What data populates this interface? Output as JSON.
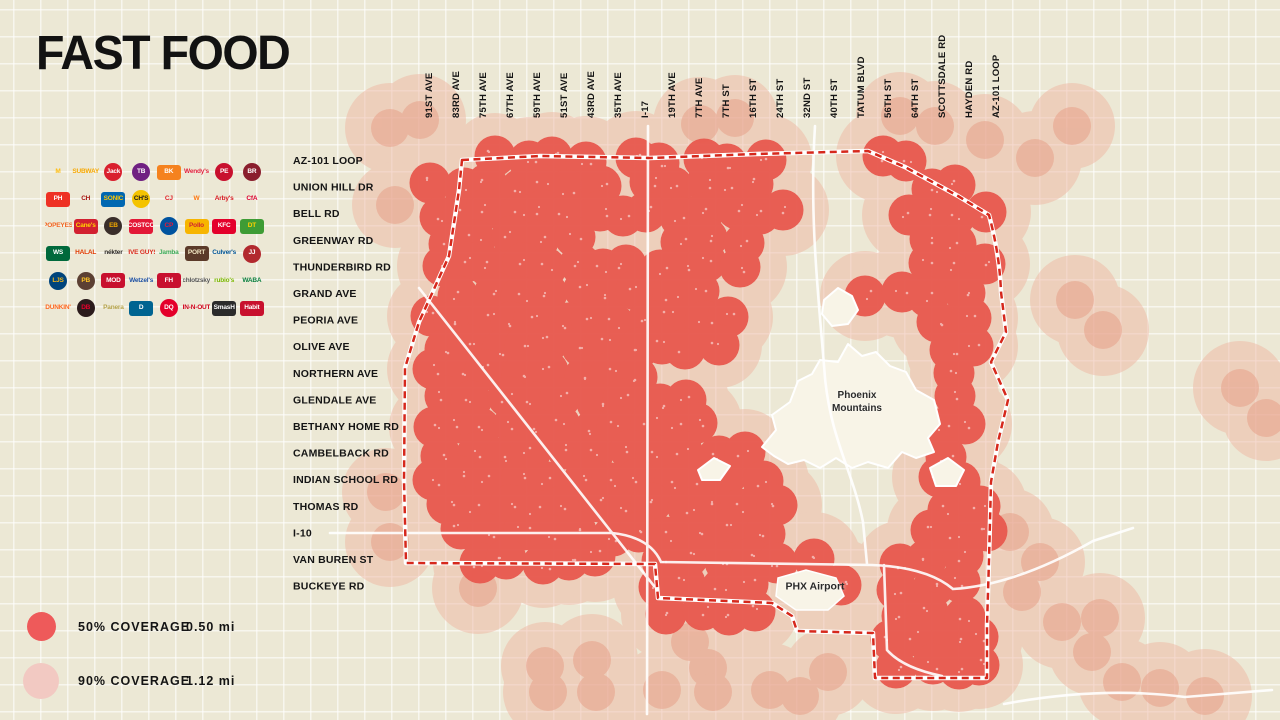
{
  "title": "FAST FOOD",
  "legend": {
    "items": [
      {
        "label": "50% COVERAGE",
        "value": "0.50 mi"
      },
      {
        "label": "90% COVERAGE",
        "value": "1.12 mi"
      }
    ]
  },
  "axes": {
    "top": [
      "91ST AVE",
      "83RD AVE",
      "75TH AVE",
      "67TH AVE",
      "59TH AVE",
      "51ST AVE",
      "43RD AVE",
      "35TH AVE",
      "I-17",
      "19TH AVE",
      "7TH AVE",
      "7TH ST",
      "16TH ST",
      "24TH ST",
      "32ND ST",
      "40TH ST",
      "TATUM BLVD",
      "56TH ST",
      "64TH ST",
      "SCOTTSDALE RD",
      "HAYDEN RD",
      "AZ-101 LOOP"
    ],
    "left": [
      "AZ-101 LOOP",
      "UNION HILL DR",
      "BELL RD",
      "GREENWAY RD",
      "THUNDERBIRD RD",
      "GRAND AVE",
      "PEORIA AVE",
      "OLIVE AVE",
      "NORTHERN AVE",
      "GLENDALE AVE",
      "BETHANY HOME RD",
      "CAMBELBACK RD",
      "INDIAN SCHOOL RD",
      "THOMAS RD",
      "I-10",
      "VAN BUREN ST",
      "BUCKEYE RD"
    ]
  },
  "logos": [
    {
      "name": "mcdonalds",
      "abbr": "M",
      "shape": "text",
      "bg": "",
      "fg": "#FFBC0D"
    },
    {
      "name": "subway",
      "abbr": "SUBWAY",
      "shape": "text",
      "bg": "",
      "fg": "#F7A800"
    },
    {
      "name": "jack-in-the-box",
      "abbr": "Jack",
      "shape": "circle",
      "bg": "#D91F2D",
      "fg": "#FFFFFF"
    },
    {
      "name": "taco-bell",
      "abbr": "TB",
      "shape": "circle",
      "bg": "#702082",
      "fg": "#FFFFFF"
    },
    {
      "name": "burger-king",
      "abbr": "BK",
      "shape": "rect",
      "bg": "#F5821F",
      "fg": "#FFFFFF"
    },
    {
      "name": "wendys",
      "abbr": "Wendy's",
      "shape": "text",
      "bg": "",
      "fg": "#E2203D"
    },
    {
      "name": "panda-express",
      "abbr": "PE",
      "shape": "circle",
      "bg": "#C8102E",
      "fg": "#FFFFFF"
    },
    {
      "name": "black-rock-coffee",
      "abbr": "BR",
      "shape": "circle",
      "bg": "#8A1E2D",
      "fg": "#FFFFFF"
    },
    {
      "name": "pizza-hut",
      "abbr": "PH",
      "shape": "rect",
      "bg": "#EE3124",
      "fg": "#FFFFFF"
    },
    {
      "name": "chipotle",
      "abbr": "CH",
      "shape": "text",
      "bg": "",
      "fg": "#A81612"
    },
    {
      "name": "sonic",
      "abbr": "SONIC",
      "shape": "rect",
      "bg": "#0067B1",
      "fg": "#FFC600"
    },
    {
      "name": "churchs-chicken",
      "abbr": "CH'S",
      "shape": "circle",
      "bg": "#F4C300",
      "fg": "#1A1A1A"
    },
    {
      "name": "carls-jr",
      "abbr": "CJ",
      "shape": "text",
      "bg": "",
      "fg": "#E0252B"
    },
    {
      "name": "whataburger",
      "abbr": "W",
      "shape": "text",
      "bg": "",
      "fg": "#FF770F"
    },
    {
      "name": "arbys",
      "abbr": "Arby's",
      "shape": "text",
      "bg": "",
      "fg": "#D71921"
    },
    {
      "name": "chick-fil-a",
      "abbr": "CfA",
      "shape": "text",
      "bg": "",
      "fg": "#DD0031"
    },
    {
      "name": "popeyes",
      "abbr": "POPEYES",
      "shape": "text",
      "bg": "",
      "fg": "#F26522"
    },
    {
      "name": "raising-canes",
      "abbr": "Cane's",
      "shape": "rect",
      "bg": "#D22030",
      "fg": "#FFD200"
    },
    {
      "name": "einstein-bros",
      "abbr": "EB",
      "shape": "circle",
      "bg": "#3A2E2A",
      "fg": "#F2A900"
    },
    {
      "name": "costco",
      "abbr": "COSTCO",
      "shape": "rect",
      "bg": "#E31837",
      "fg": "#FFFFFF"
    },
    {
      "name": "charleys",
      "abbr": "CP",
      "shape": "circle",
      "bg": "#00539F",
      "fg": "#E51937"
    },
    {
      "name": "el-pollo-loco",
      "abbr": "Pollo",
      "shape": "rect",
      "bg": "#F7B500",
      "fg": "#D22630"
    },
    {
      "name": "kfc",
      "abbr": "KFC",
      "shape": "rect",
      "bg": "#E4002B",
      "fg": "#FFFFFF"
    },
    {
      "name": "del-taco",
      "abbr": "DT",
      "shape": "rect",
      "bg": "#3E9C35",
      "fg": "#FFD100"
    },
    {
      "name": "wingstop",
      "abbr": "WS",
      "shape": "rect",
      "bg": "#00693C",
      "fg": "#FFFFFF"
    },
    {
      "name": "halal-guys",
      "abbr": "HALAL",
      "shape": "text",
      "bg": "",
      "fg": "#E03A00"
    },
    {
      "name": "nekter",
      "abbr": "nékter",
      "shape": "text",
      "bg": "",
      "fg": "#2D2926"
    },
    {
      "name": "five-guys",
      "abbr": "FIVE GUYS",
      "shape": "text",
      "bg": "",
      "fg": "#DA291C"
    },
    {
      "name": "jamba",
      "abbr": "Jamba",
      "shape": "text",
      "bg": "",
      "fg": "#3DAA57"
    },
    {
      "name": "portillos",
      "abbr": "PORT",
      "shape": "rect",
      "bg": "#5B3A29",
      "fg": "#F1E6C2"
    },
    {
      "name": "culvers",
      "abbr": "Culver's",
      "shape": "text",
      "bg": "",
      "fg": "#005596"
    },
    {
      "name": "jimmy-johns",
      "abbr": "JJ",
      "shape": "circle",
      "bg": "#B2292E",
      "fg": "#FFFFFF"
    },
    {
      "name": "long-john-silvers",
      "abbr": "LJS",
      "shape": "circle",
      "bg": "#00447C",
      "fg": "#F7B718"
    },
    {
      "name": "potbelly",
      "abbr": "PB",
      "shape": "circle",
      "bg": "#5C4033",
      "fg": "#FFC425"
    },
    {
      "name": "mod-pizza",
      "abbr": "MOD",
      "shape": "rect",
      "bg": "#C8102E",
      "fg": "#FFFFFF"
    },
    {
      "name": "wetzels-pretzels",
      "abbr": "Wetzel's",
      "shape": "text",
      "bg": "",
      "fg": "#1C4FA1"
    },
    {
      "name": "firehouse-subs",
      "abbr": "FH",
      "shape": "rect",
      "bg": "#C8102E",
      "fg": "#FFFFFF"
    },
    {
      "name": "schlotzskys",
      "abbr": "Schlotzsky's",
      "shape": "text",
      "bg": "",
      "fg": "#555555"
    },
    {
      "name": "rubios",
      "abbr": "rubio's",
      "shape": "text",
      "bg": "",
      "fg": "#7AB800"
    },
    {
      "name": "waba-grill",
      "abbr": "WABA",
      "shape": "text",
      "bg": "",
      "fg": "#0C8040"
    },
    {
      "name": "dunkin",
      "abbr": "DUNKIN'",
      "shape": "text",
      "bg": "",
      "fg": "#FF671F"
    },
    {
      "name": "dutch-bros",
      "abbr": "DB",
      "shape": "circle",
      "bg": "#2B1B1C",
      "fg": "#E4002B"
    },
    {
      "name": "panera-bread",
      "abbr": "Panera",
      "shape": "text",
      "bg": "",
      "fg": "#B5A249"
    },
    {
      "name": "dominos",
      "abbr": "D",
      "shape": "rect",
      "bg": "#006491",
      "fg": "#FFFFFF"
    },
    {
      "name": "dairy-queen",
      "abbr": "DQ",
      "shape": "circle",
      "bg": "#E4002B",
      "fg": "#FFFFFF"
    },
    {
      "name": "in-n-out",
      "abbr": "IN-N-OUT",
      "shape": "text",
      "bg": "",
      "fg": "#D0021B"
    },
    {
      "name": "smashburger",
      "abbr": "SmasH",
      "shape": "rect",
      "bg": "#2B2B2B",
      "fg": "#FFFFFF"
    },
    {
      "name": "the-habit",
      "abbr": "Habit",
      "shape": "rect",
      "bg": "#C8102E",
      "fg": "#FFFFFF"
    }
  ],
  "map": {
    "labels": {
      "mountains_line1": "Phoenix",
      "mountains_line2": "Mountains",
      "airport": "PHX Airport"
    },
    "colors": {
      "bg": "#ECE8D5",
      "grid": "#FFFFFF",
      "pink": "#EFB7A3",
      "red": "#E8594E",
      "faded": "#E79C84",
      "boundary": "#D6281C",
      "road": "#FFFFFF",
      "mountain": "#F8F4E7",
      "speckle": "#FFFFFF"
    },
    "red_radius": 20.5,
    "pink_radius": 45,
    "faded_radius": 19,
    "boundary_path": "M462,160 L540,156 L650,158 L756,154 L868,151 L905,167 L958,196 L989,215 C997,245 1000,268 1001,292 L1006,332 L991,362 L1008,400 L998,442 L991,482 L989,560 L987,625 L987,678 L875,678 L873,633 L797,631 L792,616 L772,603 L658,598 L655,564 L406,563 L404,480 L405,368 L419,322 L449,256 L459,190 Z",
    "roads": [
      "M648,126 L647,714",
      "M419,288 L654,586",
      "M815,126 C809,220 819,300 825,378 C831,440 853,472 863,522 L867,564",
      "M330,533 L612,533 Q650,537 661,562 L872,565 Q927,567 953,589 Q1016,585 1093,541 L1133,528",
      "M884,565 L887,650 Q903,668 942,676",
      "M1004,704 Q1100,686 1185,697 L1272,690"
    ],
    "mountain_paths": [
      "M762,447 L776,430 L772,415 L790,402 L798,381 L812,374 L820,360 L838,362 L848,344 L862,356 L876,352 L890,366 L906,372 L916,390 L934,400 L940,424 L928,438 L934,452 L916,458 L902,452 L888,468 L868,462 L852,468 L836,458 L820,468 L804,460 L788,464 L774,456 Z",
      "M824,300 L838,288 L852,296 L858,310 L848,324 L832,326 L822,314 Z",
      "M930,468 L948,458 L964,470 L956,486 L936,486 Z",
      "M698,470 L714,458 L730,466 L720,480 L702,480 Z"
    ],
    "airport_path": "M778,578 L806,570 L836,578 L844,596 L828,610 L796,610 L776,596 Z",
    "red_rows": [
      [
        160,
        [
          500,
          527,
          554,
          581,
          635,
          662,
          700,
          727,
          770,
          880,
          907
        ]
      ],
      [
        186,
        [
          435,
          462,
          489,
          516,
          543,
          570,
          597,
          650,
          677,
          704,
          731,
          758,
          930,
          957
        ]
      ],
      [
        213,
        [
          435,
          462,
          489,
          516,
          543,
          570,
          597,
          624,
          651,
          678,
          705,
          732,
          759,
          786,
          905,
          932,
          959,
          983
        ]
      ],
      [
        240,
        [
          450,
          480,
          510,
          540,
          570,
          680,
          710,
          740,
          930,
          960
        ]
      ],
      [
        266,
        [
          440,
          467,
          494,
          521,
          548,
          575,
          602,
          629,
          656,
          683,
          710,
          737,
          930,
          957,
          983
        ]
      ],
      [
        293,
        [
          460,
          490,
          520,
          550,
          580,
          610,
          640,
          670,
          700,
          870,
          900,
          930,
          960
        ]
      ],
      [
        320,
        [
          430,
          457,
          484,
          511,
          538,
          565,
          592,
          619,
          646,
          673,
          700,
          727,
          940,
          967
        ]
      ],
      [
        346,
        [
          445,
          472,
          499,
          526,
          553,
          580,
          607,
          634,
          661,
          688,
          715,
          950,
          977
        ]
      ],
      [
        373,
        [
          430,
          460,
          490,
          520,
          550,
          580,
          610,
          640,
          950
        ]
      ],
      [
        400,
        [
          445,
          475,
          505,
          535,
          565,
          595,
          625,
          655,
          685,
          958
        ]
      ],
      [
        426,
        [
          430,
          457,
          484,
          511,
          538,
          565,
          592,
          619,
          646,
          673,
          700,
          940,
          965
        ]
      ],
      [
        453,
        [
          445,
          475,
          505,
          535,
          565,
          595,
          625,
          655,
          685,
          715,
          745,
          950
        ]
      ],
      [
        480,
        [
          430,
          460,
          490,
          520,
          550,
          580,
          610,
          640,
          670,
          700,
          730,
          760,
          940,
          965
        ]
      ],
      [
        506,
        [
          445,
          475,
          505,
          535,
          565,
          595,
          625,
          655,
          685,
          715,
          745,
          775,
          950,
          975
        ]
      ],
      [
        533,
        [
          460,
          490,
          520,
          550,
          580,
          610,
          640,
          670,
          700,
          730,
          760,
          930,
          957,
          983
        ]
      ],
      [
        560,
        [
          480,
          510,
          540,
          570,
          600,
          660,
          690,
          720,
          750,
          780,
          810,
          900,
          930,
          960
        ]
      ],
      [
        586,
        [
          660,
          690,
          720,
          750,
          812,
          840,
          900,
          930,
          960
        ]
      ],
      [
        613,
        [
          670,
          700,
          730,
          760,
          900,
          930,
          960
        ]
      ],
      [
        640,
        [
          890,
          920,
          950,
          978
        ]
      ],
      [
        666,
        [
          900,
          930,
          960,
          984
        ]
      ]
    ],
    "outside_points": [
      [
        390,
        128
      ],
      [
        420,
        120
      ],
      [
        700,
        124
      ],
      [
        735,
        118
      ],
      [
        900,
        116
      ],
      [
        935,
        126
      ],
      [
        985,
        140
      ],
      [
        1035,
        158
      ],
      [
        1072,
        126
      ],
      [
        545,
        666
      ],
      [
        548,
        692
      ],
      [
        592,
        660
      ],
      [
        596,
        692
      ],
      [
        662,
        690
      ],
      [
        690,
        642
      ],
      [
        708,
        668
      ],
      [
        713,
        692
      ],
      [
        770,
        690
      ],
      [
        800,
        696
      ],
      [
        828,
        672
      ],
      [
        1075,
        300
      ],
      [
        1103,
        330
      ],
      [
        1240,
        388
      ],
      [
        1266,
        418
      ],
      [
        1010,
        532
      ],
      [
        1040,
        562
      ],
      [
        1022,
        592
      ],
      [
        1062,
        622
      ],
      [
        1092,
        652
      ],
      [
        1122,
        682
      ],
      [
        1100,
        618
      ],
      [
        1160,
        688
      ],
      [
        1205,
        696
      ],
      [
        395,
        205
      ],
      [
        386,
        492
      ],
      [
        390,
        542
      ],
      [
        478,
        588
      ]
    ]
  }
}
